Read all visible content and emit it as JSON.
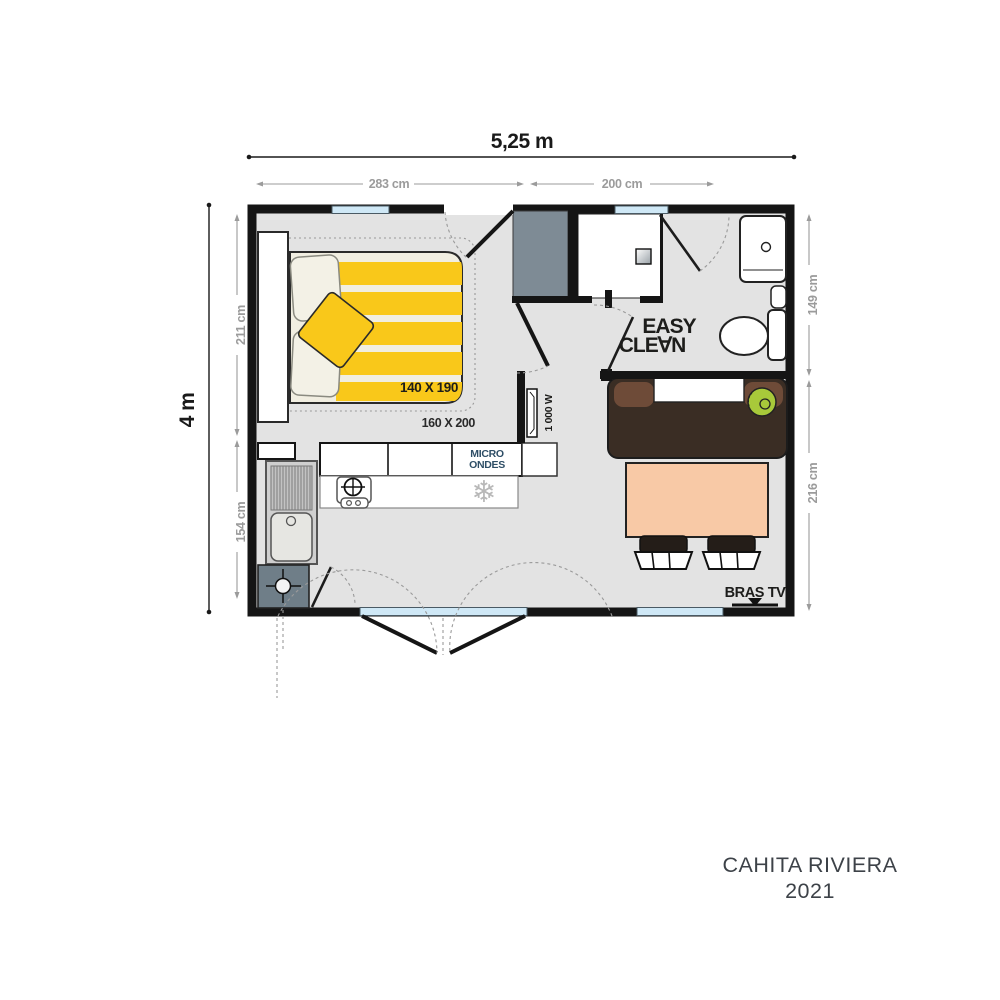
{
  "title": {
    "name": "CAHITA RIVIERA",
    "year": "2021"
  },
  "dimensions": {
    "total_width": "5,25 m",
    "total_height": "4 m",
    "top_left_room": "283 cm",
    "top_right_room": "200 cm",
    "left_upper": "211 cm",
    "left_lower": "154 cm",
    "right_upper": "149 cm",
    "right_lower": "216 cm"
  },
  "bedroom": {
    "bed_size": "140 X 190",
    "bed_size_alt": "160 X 200"
  },
  "kitchen": {
    "microwave_line1": "MICRO",
    "microwave_line2": "ONDES",
    "fridge_glyph": "❄"
  },
  "bathroom": {
    "logo_line1": "EASY",
    "logo_line2": "CLE∀N"
  },
  "living": {
    "heater_label": "1 000 W",
    "tv_label": "BRAS TV"
  },
  "palette": {
    "floor": "#e3e3e3",
    "wall": "#151515",
    "bed_yellow": "#f9c81a",
    "bed_cream": "#f1eee1",
    "table_salmon": "#f8c9a6",
    "sofa_dark_brown": "#3a2d24",
    "sofa_light_brown": "#6e4b38",
    "cushion_green": "#a8c93a",
    "wardrobe_gray": "#7e8b95",
    "window_blue": "#cfe8f6",
    "dim_gray": "#9b9b9b",
    "microwave_text": "#2e4e66"
  }
}
